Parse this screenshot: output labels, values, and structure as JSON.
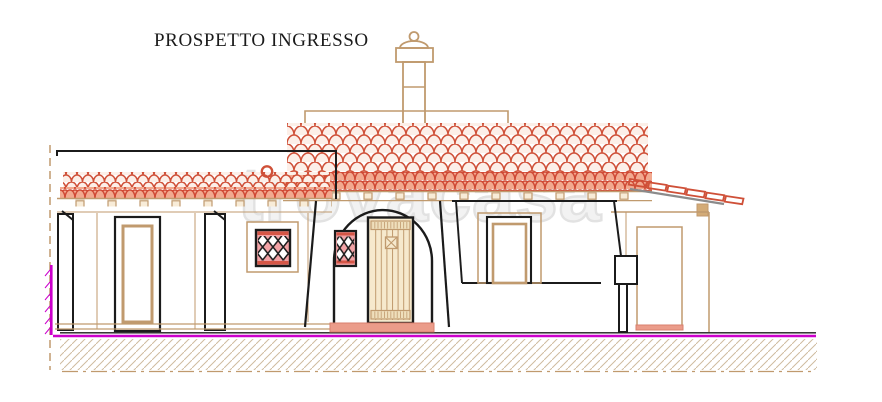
{
  "page": {
    "title": "PROSPETTO INGRESSO"
  },
  "watermark": {
    "text": "trovacasa"
  },
  "drawing": {
    "type": "architectural-elevation",
    "subject": "house entrance elevation (prospetto ingresso)",
    "elements": [
      "chimney",
      "main-tiled-roof",
      "porch-roof",
      "porch-columns",
      "french-window",
      "lattice-window-porch",
      "arched-entrance",
      "entrance-door",
      "lattice-window-entrance",
      "entrance-step",
      "right-wing-window",
      "side-pergola",
      "ground-hatch"
    ]
  },
  "colors": {
    "paper": "#ffffff",
    "ink": "#1b1b1b",
    "tan": "#c09a6e",
    "tan-light": "#d3ab77",
    "tile-red": "#cf5038",
    "tile-fill": "#fcefe8",
    "fascia-red": "#d04935",
    "fascia-fill": "#f2a98f",
    "salmon": "#eb9c8a",
    "salmon-dark": "#d87f6d",
    "pink": "#f2a3a6",
    "magenta": "#cc00cc",
    "gray": "#8b8b8b",
    "hatch": "#cfbc9f",
    "door-fill": "#f6e9cd",
    "band-fill": "#efdfbc",
    "watermark": "#e2e2e2"
  }
}
